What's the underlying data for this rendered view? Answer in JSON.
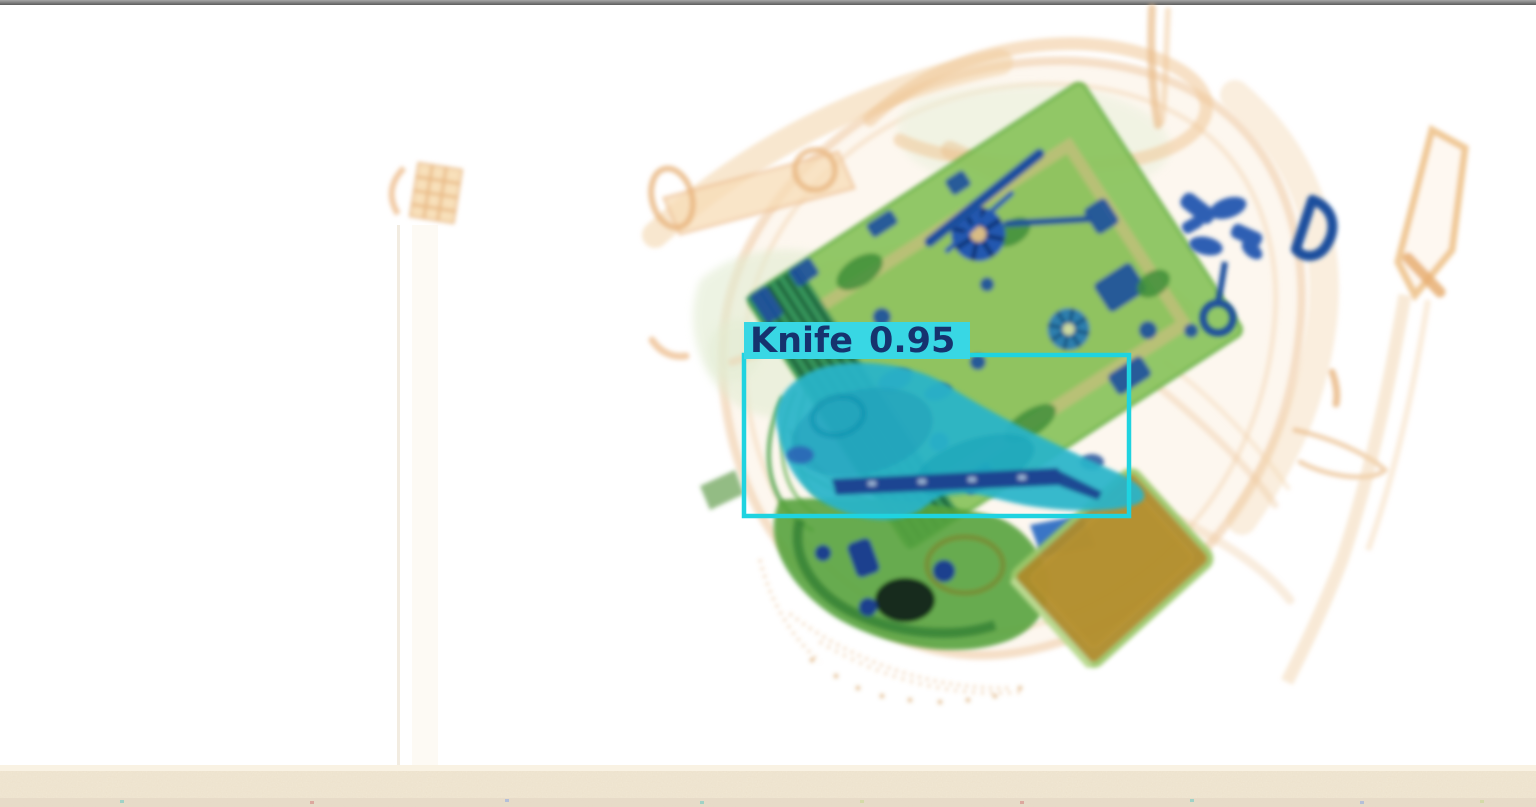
{
  "window": {
    "top_bar_color": "#8a8a8a"
  },
  "scene": {
    "name": "x-ray-baggage-scan",
    "belt_color": "#f2e8d4"
  },
  "detection": {
    "class_label": "Knife",
    "confidence": "0.95",
    "box_color": "#1fd3e0",
    "label_bg_color": "#38d7e4",
    "label_text_color": "#16336e"
  },
  "palette": {
    "background": "#ffffff",
    "bag_organic_orange": "#f0c797",
    "bag_fill_peach": "#fbeedd",
    "fabric_pale_green": "#e2ecd2",
    "pcb_green": "#8cc45f",
    "pcb_dark_green": "#2f8f5a",
    "metal_blue": "#1d4f9e",
    "knife_teal": "#2ab4c9",
    "book_olive": "#ae8c2e",
    "belt_beige": "#f2e8d4"
  }
}
